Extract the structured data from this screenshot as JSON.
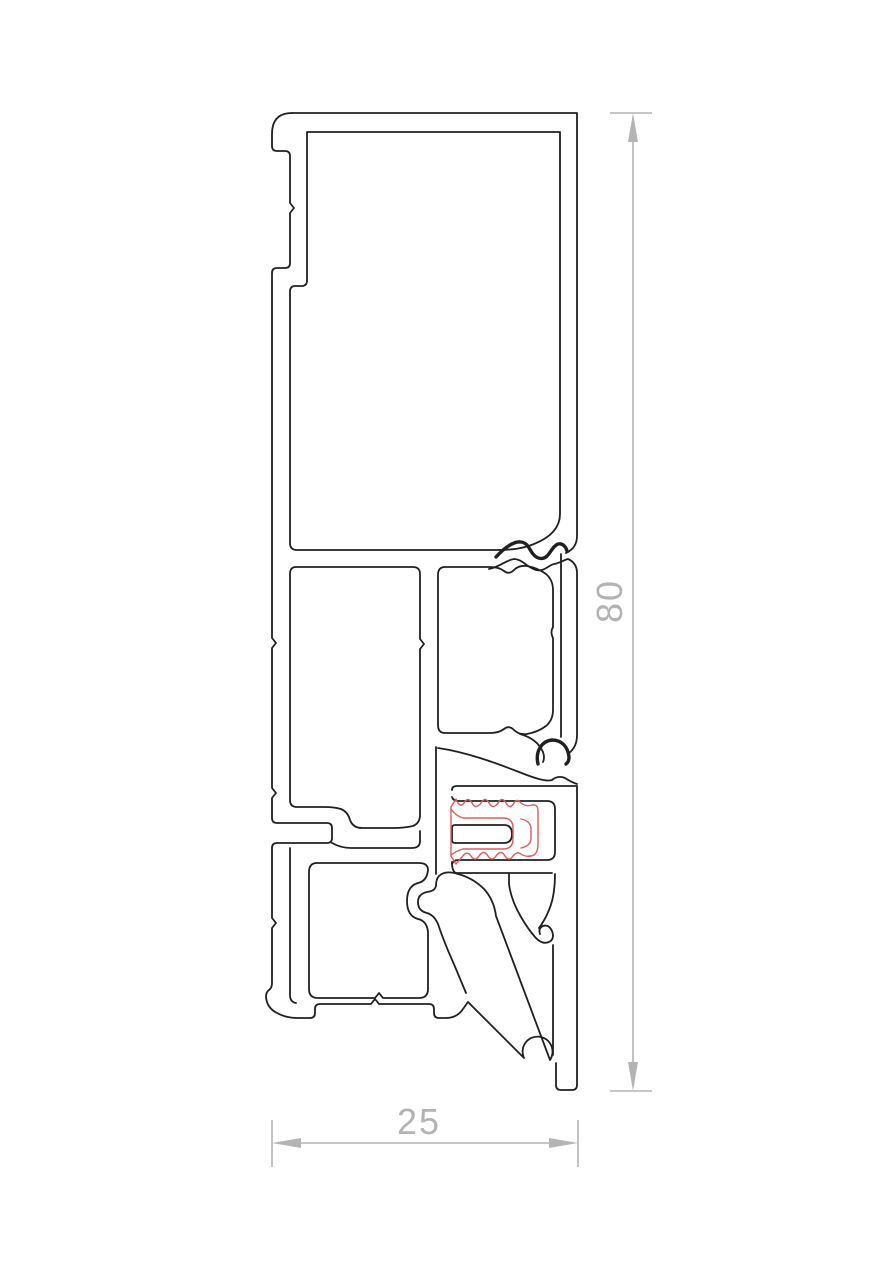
{
  "drawing": {
    "title": "aluminium-profile-cross-section",
    "dimensions": {
      "height": {
        "value": "80",
        "orientation": "vertical"
      },
      "width": {
        "value": "25",
        "orientation": "horizontal"
      }
    },
    "parts": {
      "profile": "extruded-aluminium-profile-outline",
      "gasket": "rubber-gasket-seal-detail",
      "grooves": "glazing-bead-grooves",
      "arm": "diagonal-drip-arm-with-ball-tip"
    },
    "colors": {
      "background": "#ffffff",
      "outline": "#202020",
      "gasket": "#e05c5c",
      "dimension_lines": "#b4b4b4",
      "dimension_text": "#b3b3b3"
    }
  }
}
